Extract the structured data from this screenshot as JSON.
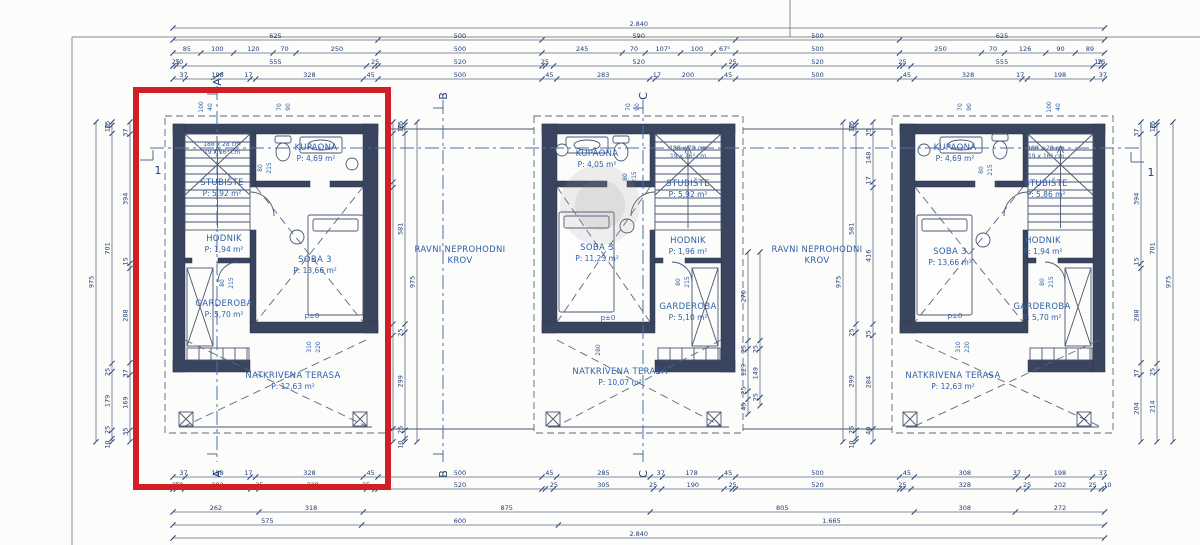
{
  "meta": {
    "type": "Floor plan drawing — second floor, three row-house units"
  },
  "colors": {
    "dim_text": "#1e3d78",
    "room_text": "#2e5fa9",
    "wall": "#39445e",
    "line": "#5a6880",
    "axis": "#4a6fae",
    "highlight": "#d12025"
  },
  "highlight": {
    "x": 136,
    "y": 90,
    "w": 252,
    "h": 397
  },
  "h_chains": [
    {
      "y": 28,
      "segs": [
        [
          2840,
          "2.840"
        ]
      ]
    },
    {
      "y": 40,
      "segs": [
        [
          625,
          "625"
        ],
        [
          500,
          "500"
        ],
        [
          590,
          "590"
        ],
        [
          500,
          "500"
        ],
        [
          625,
          "625"
        ]
      ]
    },
    {
      "y": 53,
      "segs": [
        [
          85,
          "85"
        ],
        [
          100,
          "100"
        ],
        [
          120,
          "120"
        ],
        [
          70,
          "70"
        ],
        [
          250,
          "250"
        ],
        [
          500,
          "500"
        ],
        [
          245,
          "245"
        ],
        [
          70,
          "70"
        ],
        [
          107.5,
          "107⁵"
        ],
        [
          100,
          "100"
        ],
        [
          67.5,
          "67⁵"
        ],
        [
          500,
          "500"
        ],
        [
          250,
          "250"
        ],
        [
          70,
          "70"
        ],
        [
          126,
          "126"
        ],
        [
          90,
          "90"
        ],
        [
          89,
          "89"
        ]
      ]
    },
    {
      "y": 66,
      "segs": [
        [
          10,
          "10"
        ],
        [
          25,
          "25"
        ],
        [
          555,
          "555"
        ],
        [
          25,
          "25"
        ],
        [
          10,
          ""
        ],
        [
          500,
          "520"
        ],
        [
          10,
          ""
        ],
        [
          25,
          "25"
        ],
        [
          520,
          "520"
        ],
        [
          25,
          "25"
        ],
        [
          10,
          ""
        ],
        [
          500,
          "520"
        ],
        [
          10,
          ""
        ],
        [
          25,
          "25"
        ],
        [
          555,
          "555"
        ],
        [
          25,
          "25"
        ],
        [
          10,
          "10"
        ]
      ]
    },
    {
      "y": 79,
      "segs": [
        [
          37,
          "37"
        ],
        [
          198,
          "198"
        ],
        [
          17,
          "17"
        ],
        [
          328,
          "328"
        ],
        [
          45,
          "45"
        ],
        [
          500,
          "500"
        ],
        [
          45,
          "45"
        ],
        [
          283,
          "283"
        ],
        [
          17,
          "17"
        ],
        [
          200,
          "200"
        ],
        [
          45,
          "45"
        ],
        [
          500,
          "500"
        ],
        [
          45,
          "45"
        ],
        [
          328,
          "328"
        ],
        [
          17,
          "17"
        ],
        [
          198,
          "198"
        ],
        [
          37,
          "37"
        ]
      ]
    },
    {
      "y": 477,
      "segs": [
        [
          37,
          "37"
        ],
        [
          198,
          "198"
        ],
        [
          17,
          "17"
        ],
        [
          328,
          "328"
        ],
        [
          45,
          "45"
        ],
        [
          500,
          "500"
        ],
        [
          45,
          "45"
        ],
        [
          285,
          "285"
        ],
        [
          37,
          "37"
        ],
        [
          178,
          "178"
        ],
        [
          45,
          "45"
        ],
        [
          500,
          "500"
        ],
        [
          45,
          "45"
        ],
        [
          308,
          "308"
        ],
        [
          37,
          "37"
        ],
        [
          198,
          "198"
        ],
        [
          37,
          "37"
        ]
      ]
    },
    {
      "y": 489,
      "segs": [
        [
          10,
          "10"
        ],
        [
          25,
          "25"
        ],
        [
          202,
          "202"
        ],
        [
          25,
          "25"
        ],
        [
          328,
          "328"
        ],
        [
          25,
          "25"
        ],
        [
          10,
          ""
        ],
        [
          500,
          "520"
        ],
        [
          10,
          ""
        ],
        [
          25,
          "25"
        ],
        [
          305,
          "305"
        ],
        [
          25,
          "25"
        ],
        [
          190,
          "190"
        ],
        [
          25,
          "25"
        ],
        [
          10,
          ""
        ],
        [
          500,
          "520"
        ],
        [
          10,
          ""
        ],
        [
          25,
          "25"
        ],
        [
          328,
          "328"
        ],
        [
          25,
          "25"
        ],
        [
          202,
          "202"
        ],
        [
          25,
          "25"
        ],
        [
          10,
          "10"
        ]
      ]
    },
    {
      "y": 512,
      "segs": [
        [
          262,
          "262"
        ],
        [
          318,
          "318"
        ],
        [
          875,
          "875"
        ],
        [
          805,
          "805"
        ],
        [
          308,
          "308"
        ],
        [
          272,
          "272"
        ]
      ]
    },
    {
      "y": 525,
      "segs": [
        [
          575,
          "575"
        ],
        [
          600,
          "600"
        ],
        [
          1665,
          "1.665"
        ]
      ]
    },
    {
      "y": 538,
      "segs": [
        [
          2840,
          "2.840"
        ]
      ]
    }
  ],
  "v_chains": [
    {
      "x": 96,
      "segs": [
        [
          975,
          "975"
        ]
      ]
    },
    {
      "x": 112,
      "segs": [
        [
          10,
          "10"
        ],
        [
          25,
          "25"
        ],
        [
          701,
          "701"
        ],
        [
          25,
          "25"
        ],
        [
          179,
          "179"
        ],
        [
          25,
          "25"
        ],
        [
          10,
          "10"
        ]
      ]
    },
    {
      "x": 130,
      "segs": [
        [
          37,
          "37"
        ],
        [
          394,
          "394"
        ],
        [
          15,
          "15"
        ],
        [
          288,
          "288"
        ],
        [
          37,
          "37"
        ],
        [
          169,
          "169"
        ],
        [
          35,
          "35"
        ]
      ]
    },
    {
      "x": 393,
      "segs": [
        [
          35,
          "35"
        ],
        [
          148,
          "148"
        ],
        [
          17,
          "17"
        ],
        [
          416,
          "416"
        ],
        [
          35,
          "35"
        ],
        [
          284,
          "284"
        ],
        [
          40,
          "40"
        ]
      ]
    },
    {
      "x": 405,
      "segs": [
        [
          10,
          "10"
        ],
        [
          25,
          "25"
        ],
        [
          581,
          "581"
        ],
        [
          25,
          "25"
        ],
        [
          299,
          "299"
        ],
        [
          25,
          "25"
        ],
        [
          10,
          "10"
        ]
      ]
    },
    {
      "x": 417,
      "segs": [
        [
          975,
          "975"
        ]
      ]
    },
    {
      "x": 843,
      "segs": [
        [
          975,
          "975"
        ]
      ]
    },
    {
      "x": 856,
      "segs": [
        [
          10,
          "10"
        ],
        [
          25,
          "25"
        ],
        [
          581,
          "581"
        ],
        [
          25,
          "25"
        ],
        [
          299,
          "299"
        ],
        [
          25,
          "25"
        ],
        [
          10,
          "10"
        ]
      ]
    },
    {
      "x": 873,
      "segs": [
        [
          35,
          "35"
        ],
        [
          148,
          "148"
        ],
        [
          17,
          "17"
        ],
        [
          416,
          "416"
        ],
        [
          35,
          "35"
        ],
        [
          284,
          "284"
        ],
        [
          40,
          "40"
        ]
      ]
    },
    {
      "x": 1141,
      "segs": [
        [
          37,
          "37"
        ],
        [
          394,
          "394"
        ],
        [
          15,
          "15"
        ],
        [
          288,
          "288"
        ],
        [
          37,
          "37"
        ],
        [
          204,
          "204"
        ]
      ]
    },
    {
      "x": 1157,
      "segs": [
        [
          10,
          "10"
        ],
        [
          25,
          "25"
        ],
        [
          701,
          "701"
        ],
        [
          25,
          "25"
        ],
        [
          214,
          "214"
        ]
      ]
    },
    {
      "x": 1173,
      "segs": [
        [
          975,
          "975"
        ]
      ]
    },
    {
      "x": 748,
      "y0": 252,
      "segs": [
        [
          270,
          "270"
        ],
        [
          25,
          "25"
        ],
        [
          129,
          "129"
        ],
        [
          25,
          "25"
        ],
        [
          45,
          "45"
        ]
      ]
    },
    {
      "x": 760,
      "y0": 252,
      "segs": [
        [
          270,
          ""
        ],
        [
          25,
          "25"
        ],
        [
          149,
          "149"
        ],
        [
          25,
          "25"
        ]
      ]
    }
  ],
  "rooms": [
    {
      "x": 222,
      "y": 185,
      "name": "STUBIŠTE",
      "area": "P: 5,92 m²"
    },
    {
      "x": 316,
      "y": 150,
      "name": "KUPAONA",
      "area": "P: 4,69 m²"
    },
    {
      "x": 224,
      "y": 241,
      "name": "HODNIK",
      "area": "P: 1,94 m²"
    },
    {
      "x": 315,
      "y": 262,
      "name": "SOBA 3",
      "area": "P: 13,66 m²"
    },
    {
      "x": 224,
      "y": 306,
      "name": "GARDEROBA",
      "area": "P: 5,70 m²"
    },
    {
      "x": 293,
      "y": 378,
      "name": "NATKRIVENA TERASA",
      "area": "P: 12,63 m²"
    },
    {
      "x": 597,
      "y": 156,
      "name": "KUPAONA",
      "area": "P: 4,05 m²"
    },
    {
      "x": 688,
      "y": 186,
      "name": "STUBIŠTE",
      "area": "P: 5,92 m²"
    },
    {
      "x": 597,
      "y": 250,
      "name": "SOBA 3",
      "area": "P: 11,23 m²"
    },
    {
      "x": 688,
      "y": 243,
      "name": "HODNIK",
      "area": "P: 1,96 m²"
    },
    {
      "x": 688,
      "y": 309,
      "name": "GARDEROBA",
      "area": "P: 5,10 m²"
    },
    {
      "x": 620,
      "y": 374,
      "name": "NATKRIVENA TERASA",
      "area": "P: 10,07 m²"
    },
    {
      "x": 955,
      "y": 150,
      "name": "KUPAONA",
      "area": "P: 4,69 m²"
    },
    {
      "x": 1046,
      "y": 186,
      "name": "STUBIŠTE",
      "area": "P: 5,86 m²"
    },
    {
      "x": 950,
      "y": 254,
      "name": "SOBA 3",
      "area": "P: 13,66 m²"
    },
    {
      "x": 1043,
      "y": 243,
      "name": "HODNIK",
      "area": "P: 1,94 m²"
    },
    {
      "x": 1042,
      "y": 309,
      "name": "GARDEROBA",
      "area": "P: 5,70 m²"
    },
    {
      "x": 953,
      "y": 378,
      "name": "NATKRIVENA TERASA",
      "area": "P: 12,63 m²"
    }
  ],
  "roof_labels": [
    {
      "x": 460,
      "y": 252,
      "line1": "RAVNI NEPROHODNI",
      "line2": "KROV"
    },
    {
      "x": 817,
      "y": 252,
      "line1": "RAVNI NEPROHODNI",
      "line2": "KROV"
    }
  ],
  "stair_notes": [
    {
      "x": 222,
      "y": 146,
      "line1": "188 x 28 cm",
      "line2": "19 x 16⁵ cm"
    },
    {
      "x": 688,
      "y": 150,
      "line1": "188 x 28 cm",
      "line2": "19 x 16⁵ cm"
    },
    {
      "x": 1046,
      "y": 150,
      "line1": "188 x 28 cm",
      "line2": "19 x 16⁵ cm"
    }
  ],
  "small_dims": [
    [
      203,
      107,
      "100"
    ],
    [
      212,
      107,
      "40"
    ],
    [
      281,
      107,
      "70"
    ],
    [
      290,
      107,
      "90"
    ],
    [
      630,
      107,
      "70"
    ],
    [
      639,
      107,
      "90"
    ],
    [
      962,
      107,
      "70"
    ],
    [
      971,
      107,
      "90"
    ],
    [
      1051,
      107,
      "100"
    ],
    [
      1060,
      107,
      "40"
    ],
    [
      224,
      283,
      "80"
    ],
    [
      233,
      283,
      "215"
    ],
    [
      262,
      168,
      "80"
    ],
    [
      271,
      168,
      "215"
    ],
    [
      627,
      177,
      "80"
    ],
    [
      636,
      177,
      "215"
    ],
    [
      680,
      282,
      "80"
    ],
    [
      689,
      282,
      "215"
    ],
    [
      983,
      170,
      "80"
    ],
    [
      992,
      170,
      "215"
    ],
    [
      1044,
      282,
      "80"
    ],
    [
      1053,
      282,
      "215"
    ],
    [
      311,
      347,
      "310"
    ],
    [
      320,
      347,
      "220"
    ],
    [
      600,
      350,
      "280"
    ],
    [
      960,
      347,
      "310"
    ],
    [
      969,
      347,
      "220"
    ]
  ],
  "level_marks": [
    [
      312,
      318,
      "p±0"
    ],
    [
      608,
      320,
      "p±0"
    ],
    [
      955,
      318,
      "p±0"
    ]
  ],
  "section_markers": {
    "vertical": [
      {
        "x": 217,
        "label": "A",
        "y1": 86,
        "y2": 462
      },
      {
        "x": 443,
        "label": "B",
        "y1": 100,
        "y2": 462
      },
      {
        "x": 643,
        "label": "C",
        "y1": 100,
        "y2": 462
      }
    ],
    "horizontal": {
      "y": 148,
      "x1": 150,
      "x2": 1140,
      "label": "1"
    }
  }
}
